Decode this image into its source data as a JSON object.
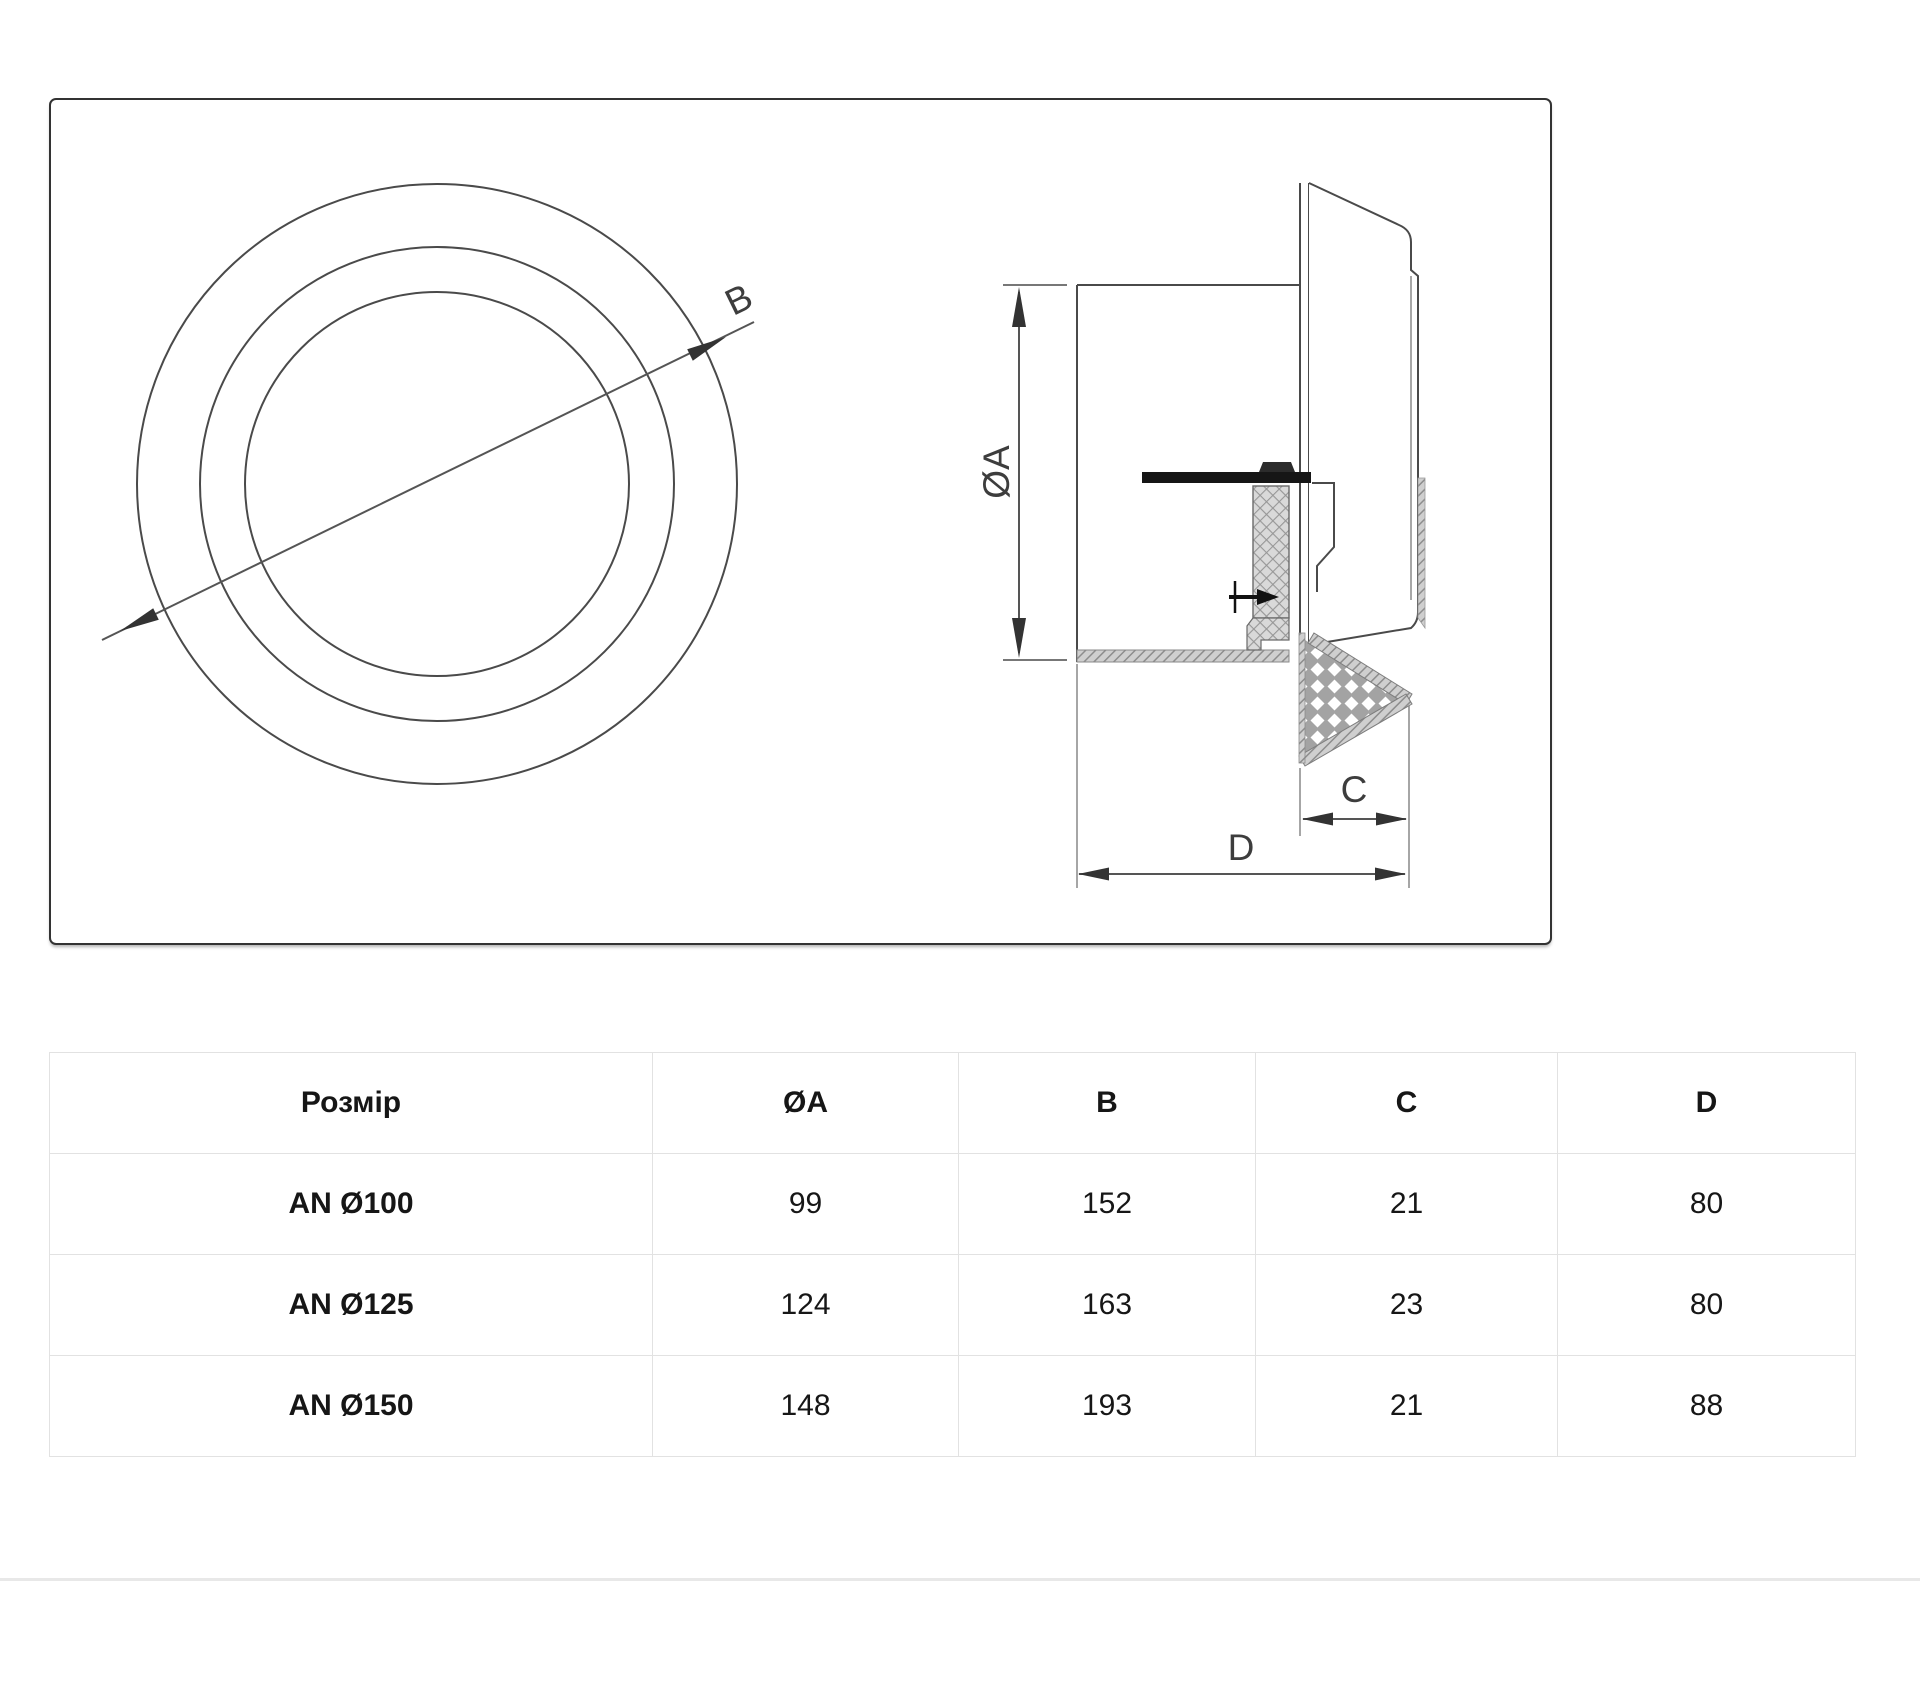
{
  "drawing": {
    "labels": {
      "b": "B",
      "oa": "ØA",
      "c": "C",
      "d": "D"
    },
    "line_color": "#4a4a4a",
    "dim_color": "#555555",
    "hatch_color": "#9a9a9a"
  },
  "table": {
    "headers": [
      "Розмір",
      "ØA",
      "B",
      "C",
      "D"
    ],
    "rows": [
      {
        "size": "AN Ø100",
        "oa": "99",
        "b": "152",
        "c": "21",
        "d": "80"
      },
      {
        "size": "AN Ø125",
        "oa": "124",
        "b": "163",
        "c": "23",
        "d": "80"
      },
      {
        "size": "AN Ø150",
        "oa": "148",
        "b": "193",
        "c": "21",
        "d": "88"
      }
    ]
  }
}
